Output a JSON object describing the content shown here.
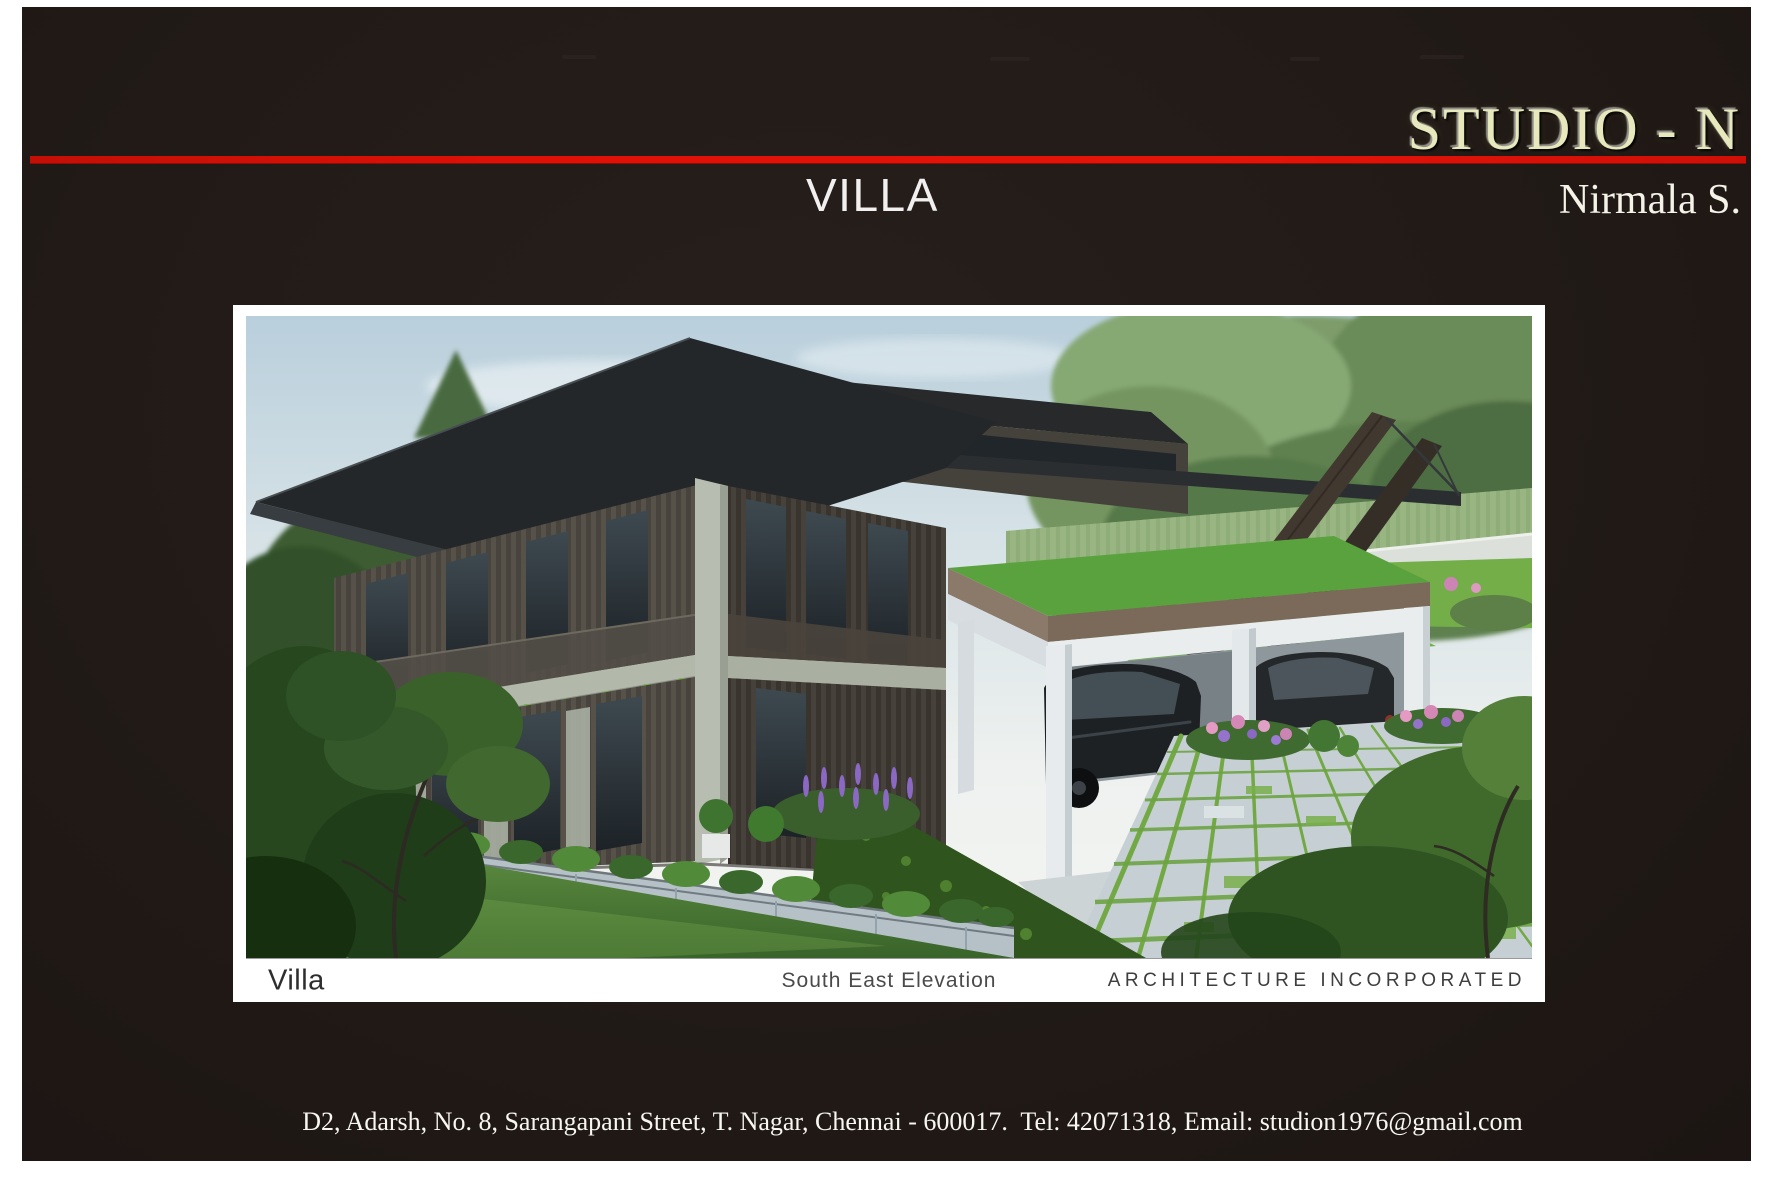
{
  "header": {
    "studio_name": "STUDIO - N",
    "author": "Nirmala S."
  },
  "slide_title": "VILLA",
  "title_block": {
    "project": "Villa",
    "view": "South East Elevation",
    "firm": "ARCHITECTURE INCORPORATED"
  },
  "footer": {
    "contact_line": "D2, Adarsh, No. 8, Sarangapani Street, T. Nagar, Chennai - 600017.  Tel: 42071318, Email: studion1976@gmail.com"
  },
  "rendering": {
    "alt": "3D exterior rendering of a modern flat-roofed two-storey villa seen from the south east, with wood louvre facade, hanging balcony planters, a white carport sheltering two dark cars, an angled timber pylon, stone boundary wall, lawn and a paved garden court with grass joints"
  },
  "colors": {
    "accent_red": "#df1107",
    "studio_gold": "#e7e9bd",
    "slide_bg": "#211a16",
    "paper_white": "#ffffff"
  }
}
